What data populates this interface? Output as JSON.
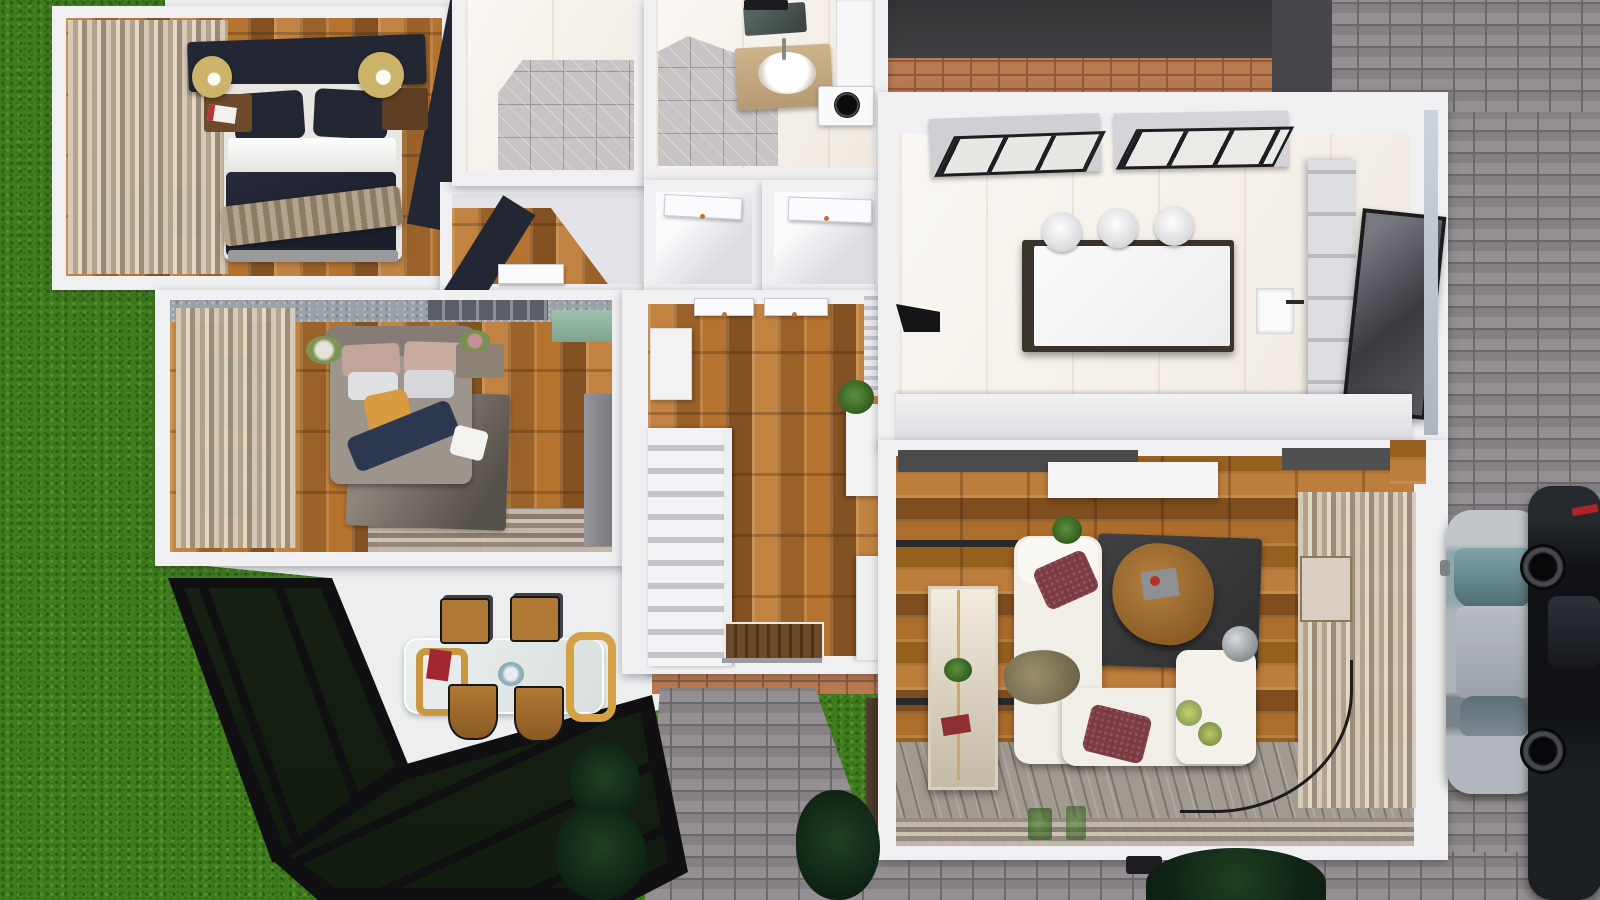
{
  "app": {
    "title": "3D House Floor Plan Render - Top-Down View"
  },
  "palette": {
    "wall": "#f0f0f2",
    "grass": "#3f7d1e",
    "grassDark": "#2b5a11",
    "grassLight": "#55942c",
    "paver": "#8d888b",
    "paverJoint": "#6d686c",
    "brick": "#b97a52",
    "brickJoint": "#8e5a3a",
    "wood": "#a8692f",
    "navy": "#232633",
    "curtain": "#c3b7a5",
    "carpet": "#a19a90",
    "marble": "#f3eee6",
    "tileGray": "#c8c3c5",
    "sofa": "#f1eee8",
    "rug": "#3b3b3d",
    "maroon": "#7c3a42",
    "teal": "#9fc0ae",
    "gold": "#cbb469",
    "islandTop": "#f6f6f7",
    "islandBase": "#3a332b",
    "carSilver": "#9aa3a8",
    "carBlack": "#17191d",
    "canopyFrame": "#101013"
  },
  "rooms": [
    {
      "id": "bedroom-1",
      "label": "Bedroom 1",
      "furniture": [
        "double-bed",
        "navy-headboard",
        "navy-pillows",
        "white-sheet",
        "navy-duvet",
        "knit-throw",
        "nightstand-left",
        "nightstand-right",
        "gold-lamp-left",
        "gold-lamp-right",
        "magazine",
        "curtains",
        "garden-window"
      ]
    },
    {
      "id": "shower-room",
      "label": "Shower Room",
      "furniture": [
        "marble-walls",
        "gray-tile-floor"
      ]
    },
    {
      "id": "bathroom",
      "label": "Bathroom",
      "furniture": [
        "vanity-counter",
        "oval-sink",
        "faucet",
        "mirror",
        "washing-machine",
        "white-cabinets",
        "gray-tile-floor"
      ]
    },
    {
      "id": "closet-left",
      "label": "Closet",
      "furniture": [
        "white-door"
      ]
    },
    {
      "id": "closet-right",
      "label": "Closet",
      "furniture": [
        "white-door"
      ]
    },
    {
      "id": "vestibule",
      "label": "Vestibule",
      "furniture": [
        "white-door",
        "wood-floor"
      ]
    },
    {
      "id": "bedroom-2",
      "label": "Bedroom 2",
      "furniture": [
        "double-bed",
        "mauve-pillows",
        "orange-pillow",
        "navy-throw",
        "gray-rug",
        "nightstand",
        "flower-vase",
        "gray-wardrobe",
        "teal-cabinet",
        "curtains",
        "garden-windows",
        "window-blinds"
      ]
    },
    {
      "id": "hallway",
      "label": "Hallway",
      "furniture": [
        "staircase",
        "stair-railing",
        "wall-cabinet",
        "console-table",
        "potted-plant",
        "radiator",
        "bench",
        "doormat",
        "front-door",
        "interior-doors"
      ]
    },
    {
      "id": "kitchen",
      "label": "Kitchen",
      "furniture": [
        "island",
        "bar-stools",
        "skylight-left",
        "skylight-right",
        "tall-cabinets",
        "glass-door",
        "bottom-counter",
        "cooker-hood",
        "wall-niche"
      ]
    },
    {
      "id": "living-room",
      "label": "Living Room",
      "furniture": [
        "sectional-sofa",
        "ottoman",
        "maroon-pillows",
        "olive-throw",
        "dark-rug",
        "triangle-coffee-table",
        "remote-tray",
        "tv-cabinet",
        "tv-console",
        "curio-cabinet",
        "red-book",
        "curtains",
        "window",
        "sphere-lamp",
        "lamp-wire",
        "plant-stand",
        "striped-carpet",
        "subwoofer"
      ]
    },
    {
      "id": "dining-area",
      "label": "Dining Area",
      "furniture": [
        "glass-dining-table",
        "bentwood-frame",
        "dining-chairs",
        "red-runner",
        "flower-vase"
      ]
    }
  ],
  "exterior": {
    "features": [
      "lawn",
      "glass-canopy-upper",
      "glass-canopy-lower",
      "paver-driveway",
      "paver-walkway",
      "brick-edging",
      "patio-brick-band",
      "roof-edge-band",
      "silver-car",
      "black-car",
      "shrubs-left",
      "shrubs-right",
      "hedge-wall",
      "tree-bottom"
    ]
  },
  "counts": {
    "bedrooms": 2,
    "bar_stools": 3,
    "dining_chairs": 4,
    "cars": 2,
    "skylights": 2,
    "closets": 2
  }
}
